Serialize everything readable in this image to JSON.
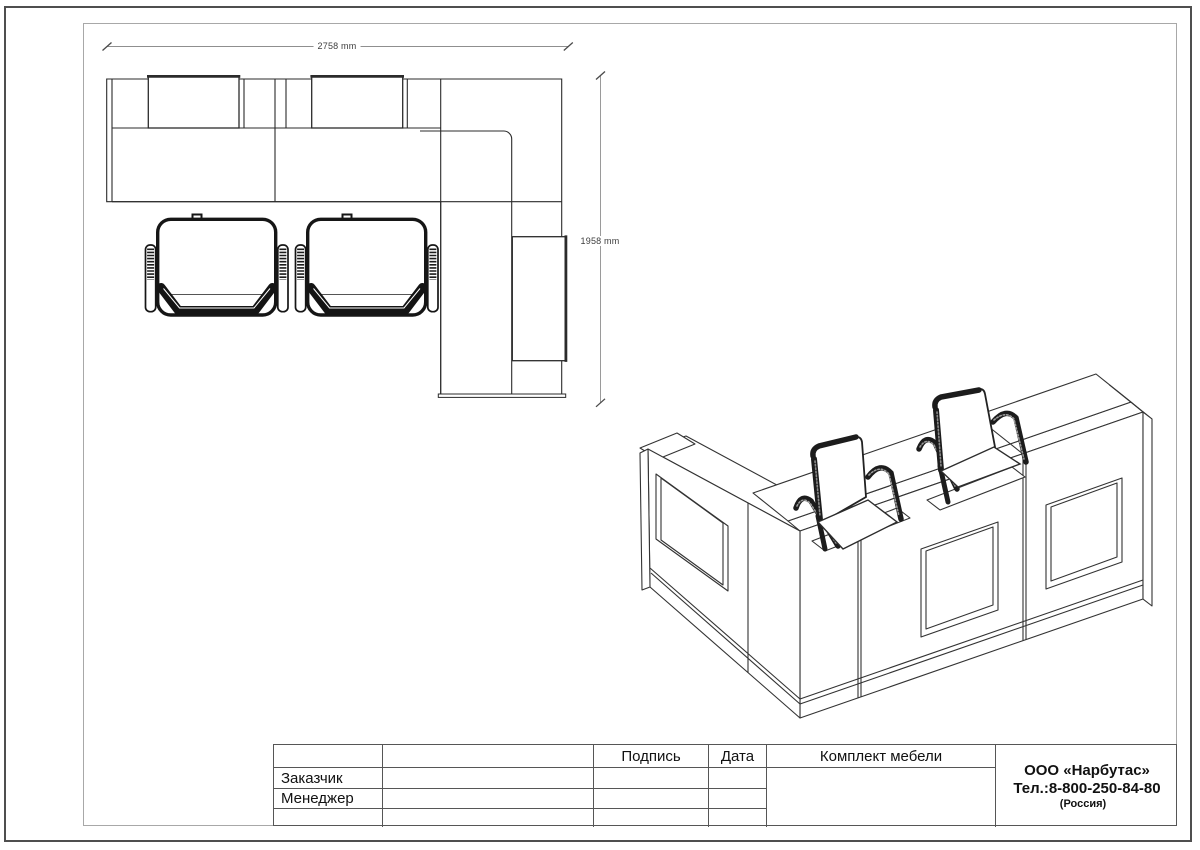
{
  "dimensions": {
    "width_label": "2758 mm",
    "height_label": "1958 mm"
  },
  "title_block": {
    "signature_header": "Подпись",
    "date_header": "Дата",
    "row_customer": "Заказчик",
    "row_manager": "Менеджер",
    "project_title": "Комплект мебели",
    "company_name": "ООО «Нарбутас»",
    "company_phone": "Тел.:8-800-250-84-80",
    "company_country": "(Россия)"
  },
  "colors": {
    "line": "#2b2b2b",
    "chair": "#161616",
    "dim": "#8f8f8f",
    "frame": "#a8a8a8",
    "border": "#4f4f4f"
  }
}
